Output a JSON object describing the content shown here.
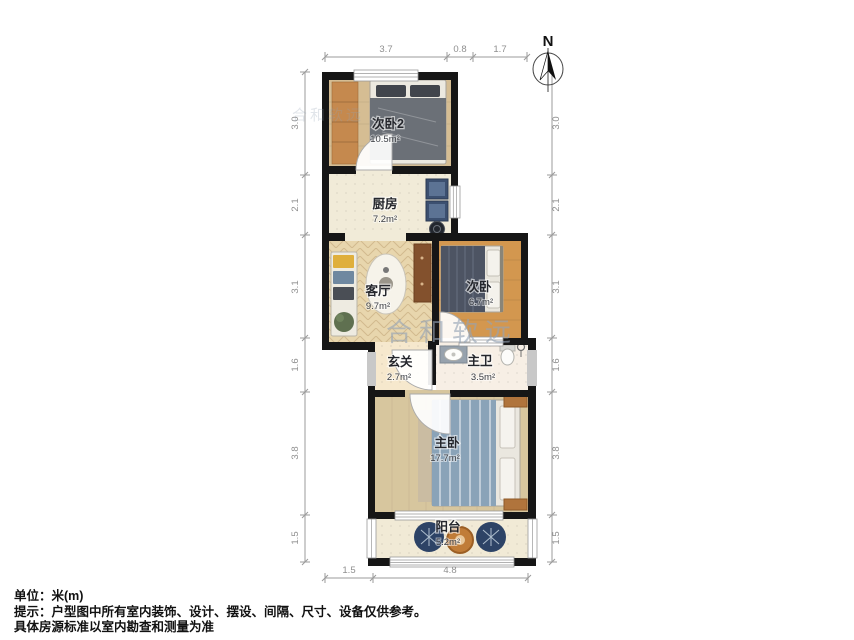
{
  "compass": {
    "label": "N"
  },
  "watermark": {
    "text": "合和软远",
    "color": "#94a3b4"
  },
  "rooms": [
    {
      "id": "bedroom2",
      "name": "次卧2",
      "area": "10.5m²"
    },
    {
      "id": "kitchen",
      "name": "厨房",
      "area": "7.2m²"
    },
    {
      "id": "living",
      "name": "客厅",
      "area": "9.7m²"
    },
    {
      "id": "bedroom",
      "name": "次卧",
      "area": "6.7m²"
    },
    {
      "id": "entry",
      "name": "玄关",
      "area": "2.7m²"
    },
    {
      "id": "bath",
      "name": "主卫",
      "area": "3.5m²"
    },
    {
      "id": "master",
      "name": "主卧",
      "area": "17.7m²"
    },
    {
      "id": "balcony",
      "name": "阳台",
      "area": "5.2m²"
    }
  ],
  "dimensions": {
    "top": [
      "3.7",
      "0.8",
      "1.7"
    ],
    "left": [
      "3.0",
      "2.1",
      "3.1",
      "1.6",
      "3.8",
      "1.5"
    ],
    "right": [
      "3.0",
      "2.1",
      "3.1",
      "1.6",
      "3.8",
      "1.5"
    ],
    "bottom": [
      "1.5",
      "4.8"
    ]
  },
  "footer": {
    "line1": "单位：米(m)",
    "line2": "提示：户型图中所有室内装饰、设计、摆设、间隔、尺寸、设备仅供参考。",
    "line3": "具体房源标准以室内勘查和测量为准"
  },
  "colors": {
    "wall": "#161616",
    "dimension_line": "#9b9b9b",
    "wood_light": "#d5bd93",
    "wood_orange": "#d3974f",
    "tile_cream": "#f1ebd8",
    "accent_counter": "#3c5070",
    "accent_bed_blue": "#8aa3b8"
  }
}
